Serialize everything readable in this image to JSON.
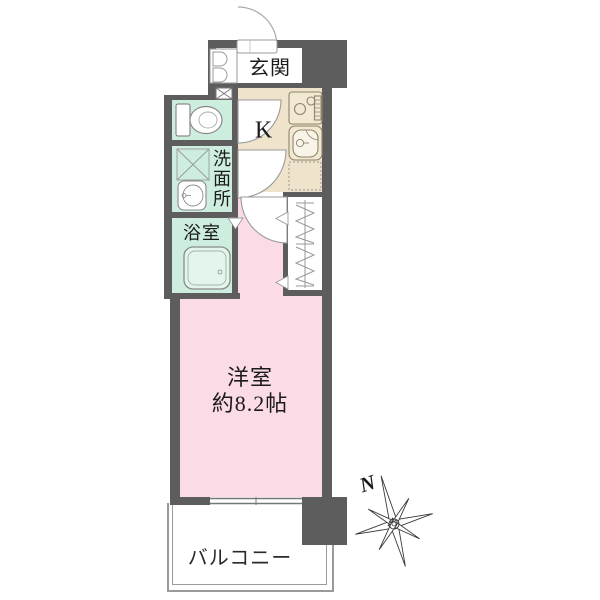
{
  "plan": {
    "rooms": {
      "entrance_label": "玄関",
      "kitchen_label": "K",
      "washroom_label": "洗面所",
      "bathroom_label": "浴室",
      "main_room_label": "洋室",
      "main_room_size": "約8.2帖",
      "balcony_label": "バルコニー"
    },
    "compass_label": "N",
    "colors": {
      "wall": "#5d5d5d",
      "main_room_pink": "#fbdce6",
      "wet_area_mint": "#cdeede",
      "kitchen_beige": "#efe3cb",
      "outline_gray": "#999999"
    },
    "icons": [
      "toilet",
      "washing-machine-pan",
      "washbasin",
      "bathtub",
      "gas-stove",
      "kitchen-sink",
      "refrigerator-space",
      "shoe-cabinet",
      "meter-box",
      "closet-hanger",
      "door-swing",
      "compass-rose"
    ]
  }
}
